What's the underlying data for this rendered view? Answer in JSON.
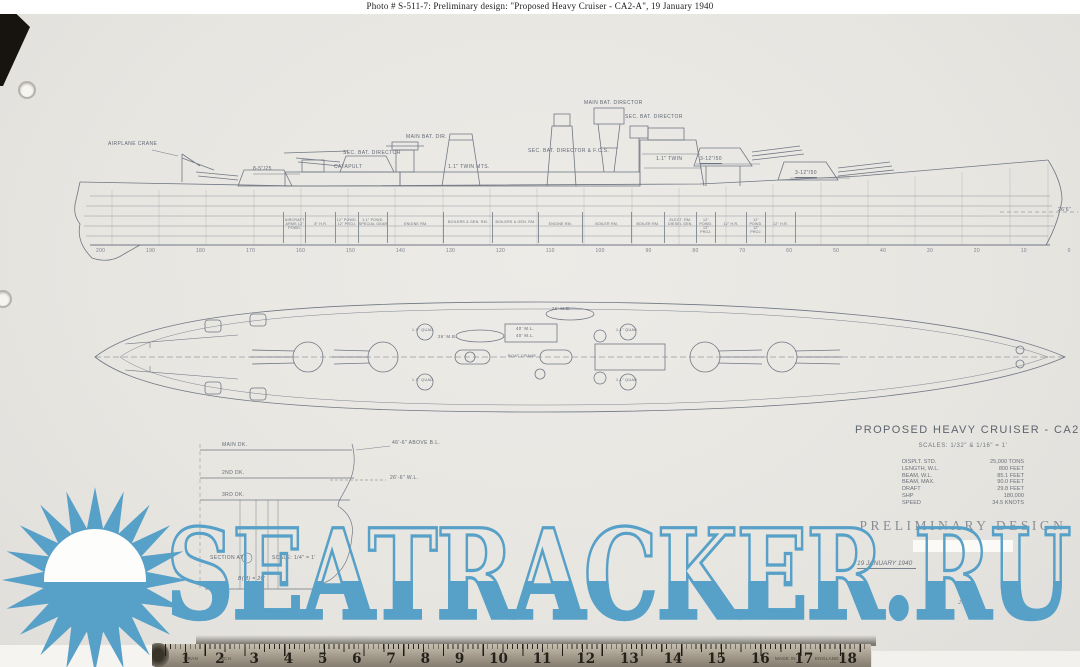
{
  "caption": "Photo #  S-511-7:    Preliminary design:   \"Proposed Heavy Cruiser - CA2-A\", 19 January 1940",
  "colors": {
    "watermark_blue": "#57a0c7",
    "paper": "#e9e7e2",
    "pencil": "#707784"
  },
  "drawing": {
    "profile": {
      "labels": {
        "airplane_crane": "AIRPLANE CRANE",
        "sec_battery": "8-5\"/25",
        "catapult": "CATAPULT",
        "sec_bat_director_aft": "SEC. BAT. DIRECTOR",
        "main_bat_dir_aft": "MAIN BAT. DIR.",
        "twin_mount_aft": "1.1\" TWIN MTS.",
        "sec_bat_director_fcs": "SEC. BAT. DIRECTOR & F.C.S.",
        "main_bat_director": "MAIN BAT. DIRECTOR",
        "sec_bat_director_fwd": "SEC. BAT. DIRECTOR",
        "twin_mount_fwd": "1.1\" TWIN",
        "main_battery_no2": "3-12\"/50",
        "main_battery_no1": "3-12\"/50",
        "bow_waterline": "26'6\""
      },
      "compartments": [
        "AIRCRAFT ARMS 12\" POWD.",
        "8\" H.R.",
        "12\" POWD. 12\" PROJ.",
        "1.1\" POWD. SPECIAL GEAR",
        "ENGINE RM.",
        "BOILERS & GEN. RM.",
        "BOILERS & GEN. RM.",
        "ENGINE RM.",
        "BOILER RM.",
        "BOILER RM.",
        "ELECT. RM. DIESEL GEN.",
        "12\" POWD. 12\" PROJ.",
        "12\" H.R.",
        "12\" POWD. 12\" PROJ.",
        "12\" H.R."
      ],
      "stations": [
        "200",
        "190",
        "180",
        "170",
        "160",
        "150",
        "140",
        "130",
        "120",
        "110",
        "100",
        "90",
        "80",
        "70",
        "60",
        "50",
        "40",
        "30",
        "20",
        "10",
        "0"
      ]
    },
    "plan": {
      "labels": {
        "motor_boat_1": "26' M.B.",
        "motor_boat_2": "26' M.B.",
        "motor_launch_1": "40' M.L.",
        "motor_launch_2": "40' M.L.",
        "quad_1": "1.1\" QUAD",
        "quad_2": "1.1\" QUAD",
        "quad_3": "1.1\" QUAD",
        "quad_4": "1.1\" QUAD",
        "boat_crane": "BOAT CRANE"
      }
    },
    "section": {
      "deck_1": "MAIN DK.",
      "deck_2": "2ND DK.",
      "deck_3": "3RD DK.",
      "height_note": "46'-6\" ABOVE B.L.",
      "waterline_note": "26'-6\" W.L.",
      "caption": "SECTION AT",
      "scale_note": "SCALE: 1/4\" = 1'",
      "beam_note": "B(M) = 20'"
    }
  },
  "title_block": {
    "title": "PROPOSED  HEAVY  CRUISER - CA2-A",
    "scale_line": "SCALES:  1/32\" & 1/16\" = 1'",
    "specs": [
      {
        "label": "DISPLT. STD.",
        "value": "25,000 TONS"
      },
      {
        "label": "LENGTH, W.L.",
        "value": "800 FEET"
      },
      {
        "label": "BEAM, W.L.",
        "value": "85.1 FEET"
      },
      {
        "label": "BEAM, MAX.",
        "value": "90.0 FEET"
      },
      {
        "label": "DRAFT",
        "value": "29.8 FEET"
      },
      {
        "label": "SHP",
        "value": "180,000"
      },
      {
        "label": "SPEED",
        "value": "34.5 KNOTS"
      }
    ],
    "stamp": "PRELIMINARY DESIGN",
    "date": "19 JANUARY 1940",
    "initials": "J.J."
  },
  "watermark": {
    "text": "SEATRACKER.RU"
  },
  "ruler": {
    "numbers": [
      "1",
      "2",
      "3",
      "4",
      "5",
      "6",
      "7",
      "8",
      "9",
      "10",
      "11",
      "12",
      "13",
      "14",
      "15",
      "16",
      "17",
      "18"
    ],
    "word_1": "TIRAN",
    "word_2": "INCH",
    "word_3": "MADE IN",
    "word_4": "ENGLAND"
  }
}
